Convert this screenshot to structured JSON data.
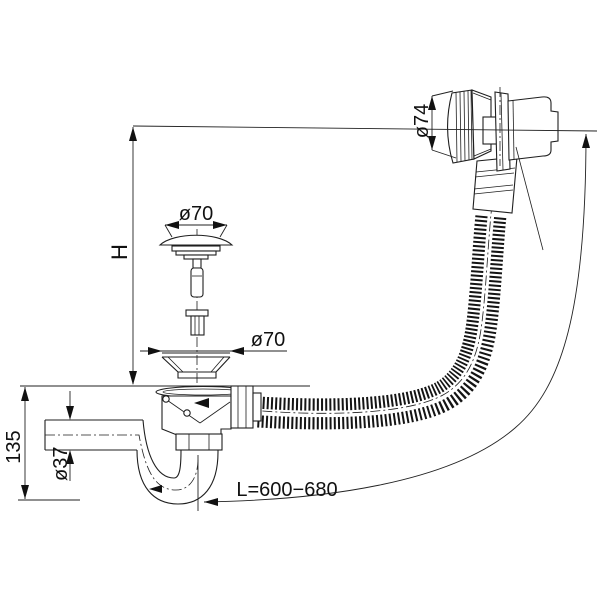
{
  "drawing": {
    "labels": {
      "overflow_diameter": "ø74",
      "plug_diameter": "ø70",
      "strainer_diameter": "ø70",
      "height": "H",
      "trap_height": "135",
      "pipe_diameter": "ø37",
      "hose_length": "L=600−680"
    },
    "colors": {
      "line": "#1f1f1f",
      "background": "#ffffff"
    }
  }
}
